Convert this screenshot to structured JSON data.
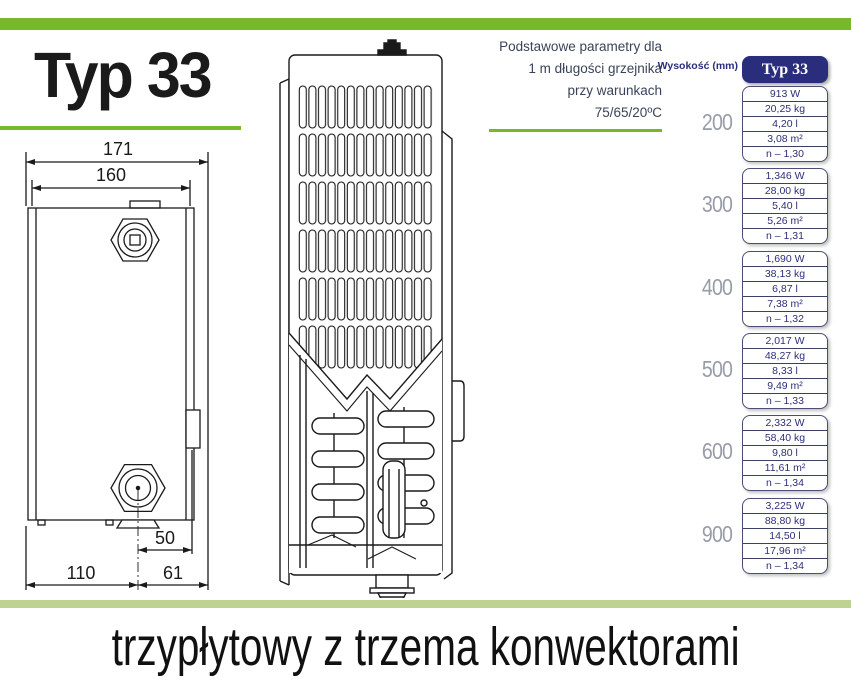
{
  "title": "Typ 33",
  "subtitle": "trzypłytowy z trzema konwektorami",
  "note": {
    "lines": [
      "Podstawowe parametry dla",
      "1 m długości grzejnika",
      "przy warunkach",
      "75/65/20ºC"
    ]
  },
  "drawing": {
    "dims": {
      "top_width": "171",
      "inner_width": "160",
      "bottom_offset": "50",
      "bottom_left": "110",
      "bottom_right": "61"
    }
  },
  "table": {
    "row_header": "Wysokość (mm)",
    "col_header": "Typ 33",
    "groups": [
      {
        "height": "200",
        "values": [
          "913 W",
          "20,25 kg",
          "4,20 l",
          "3,08 m²",
          "n – 1,30"
        ]
      },
      {
        "height": "300",
        "values": [
          "1,346 W",
          "28,00 kg",
          "5,40 l",
          "5,26 m²",
          "n – 1,31"
        ]
      },
      {
        "height": "400",
        "values": [
          "1,690 W",
          "38,13 kg",
          "6,87 l",
          "7,38 m²",
          "n – 1,32"
        ]
      },
      {
        "height": "500",
        "values": [
          "2,017 W",
          "48,27 kg",
          "8,33 l",
          "9,49 m²",
          "n – 1,33"
        ]
      },
      {
        "height": "600",
        "values": [
          "2,332 W",
          "58,40 kg",
          "9,80 l",
          "11,61 m²",
          "n – 1,34"
        ]
      },
      {
        "height": "900",
        "values": [
          "3,225 W",
          "88,80 kg",
          "14,50 l",
          "17,96 m²",
          "n – 1,34"
        ]
      }
    ]
  },
  "colors": {
    "accent_green": "#76b82a",
    "pale_green": "#bed391",
    "navy": "#2a2d7c",
    "height_gray": "#989ba8"
  }
}
